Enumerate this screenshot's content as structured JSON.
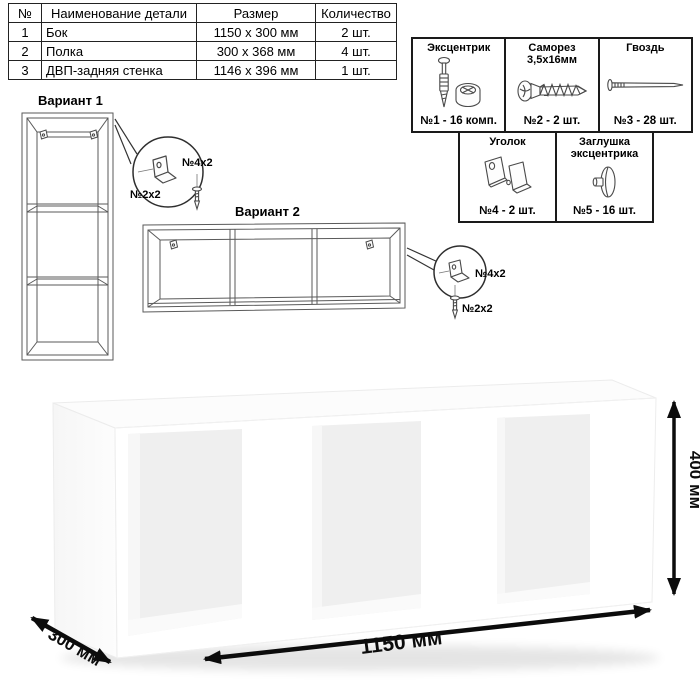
{
  "parts_table": {
    "headers": [
      "№",
      "Наименование детали",
      "Размер",
      "Количество"
    ],
    "rows": [
      {
        "num": "1",
        "name": "Бок",
        "size": "1150 х 300 мм",
        "qty": "2 шт."
      },
      {
        "num": "2",
        "name": "Полка",
        "size": "300 х 368 мм",
        "qty": "4 шт."
      },
      {
        "num": "3",
        "name": "ДВП-задняя стенка",
        "size": "1146 х 396 мм",
        "qty": "1 шт."
      }
    ]
  },
  "hardware": {
    "items": [
      {
        "title": "Эксцентрик",
        "count": "№1 - 16 комп.",
        "icon": "cam-lock-icon"
      },
      {
        "title": "Саморез 3,5х16мм",
        "count": "№2 - 2 шт.",
        "icon": "screw-icon"
      },
      {
        "title": "Гвоздь",
        "count": "№3 - 28 шт.",
        "icon": "nail-icon"
      },
      {
        "title": "Уголок",
        "count": "№4 - 2 шт.",
        "icon": "corner-bracket-icon"
      },
      {
        "title": "Заглушка эксцентрика",
        "count": "№5 - 16 шт.",
        "icon": "cam-cap-icon"
      }
    ]
  },
  "variant1": {
    "title": "Вариант 1",
    "bracket_label": "№4х2",
    "screw_label": "№2х2"
  },
  "variant2": {
    "title": "Вариант 2",
    "bracket_label": "№4х2",
    "screw_label": "№2х2"
  },
  "dimensions": {
    "width": "1150 мм",
    "depth": "300 мм",
    "height": "400 мм"
  },
  "colors": {
    "line_black": "#111111",
    "drawing_gray": "#5a5a5a",
    "interior_gray": "#efefef"
  }
}
